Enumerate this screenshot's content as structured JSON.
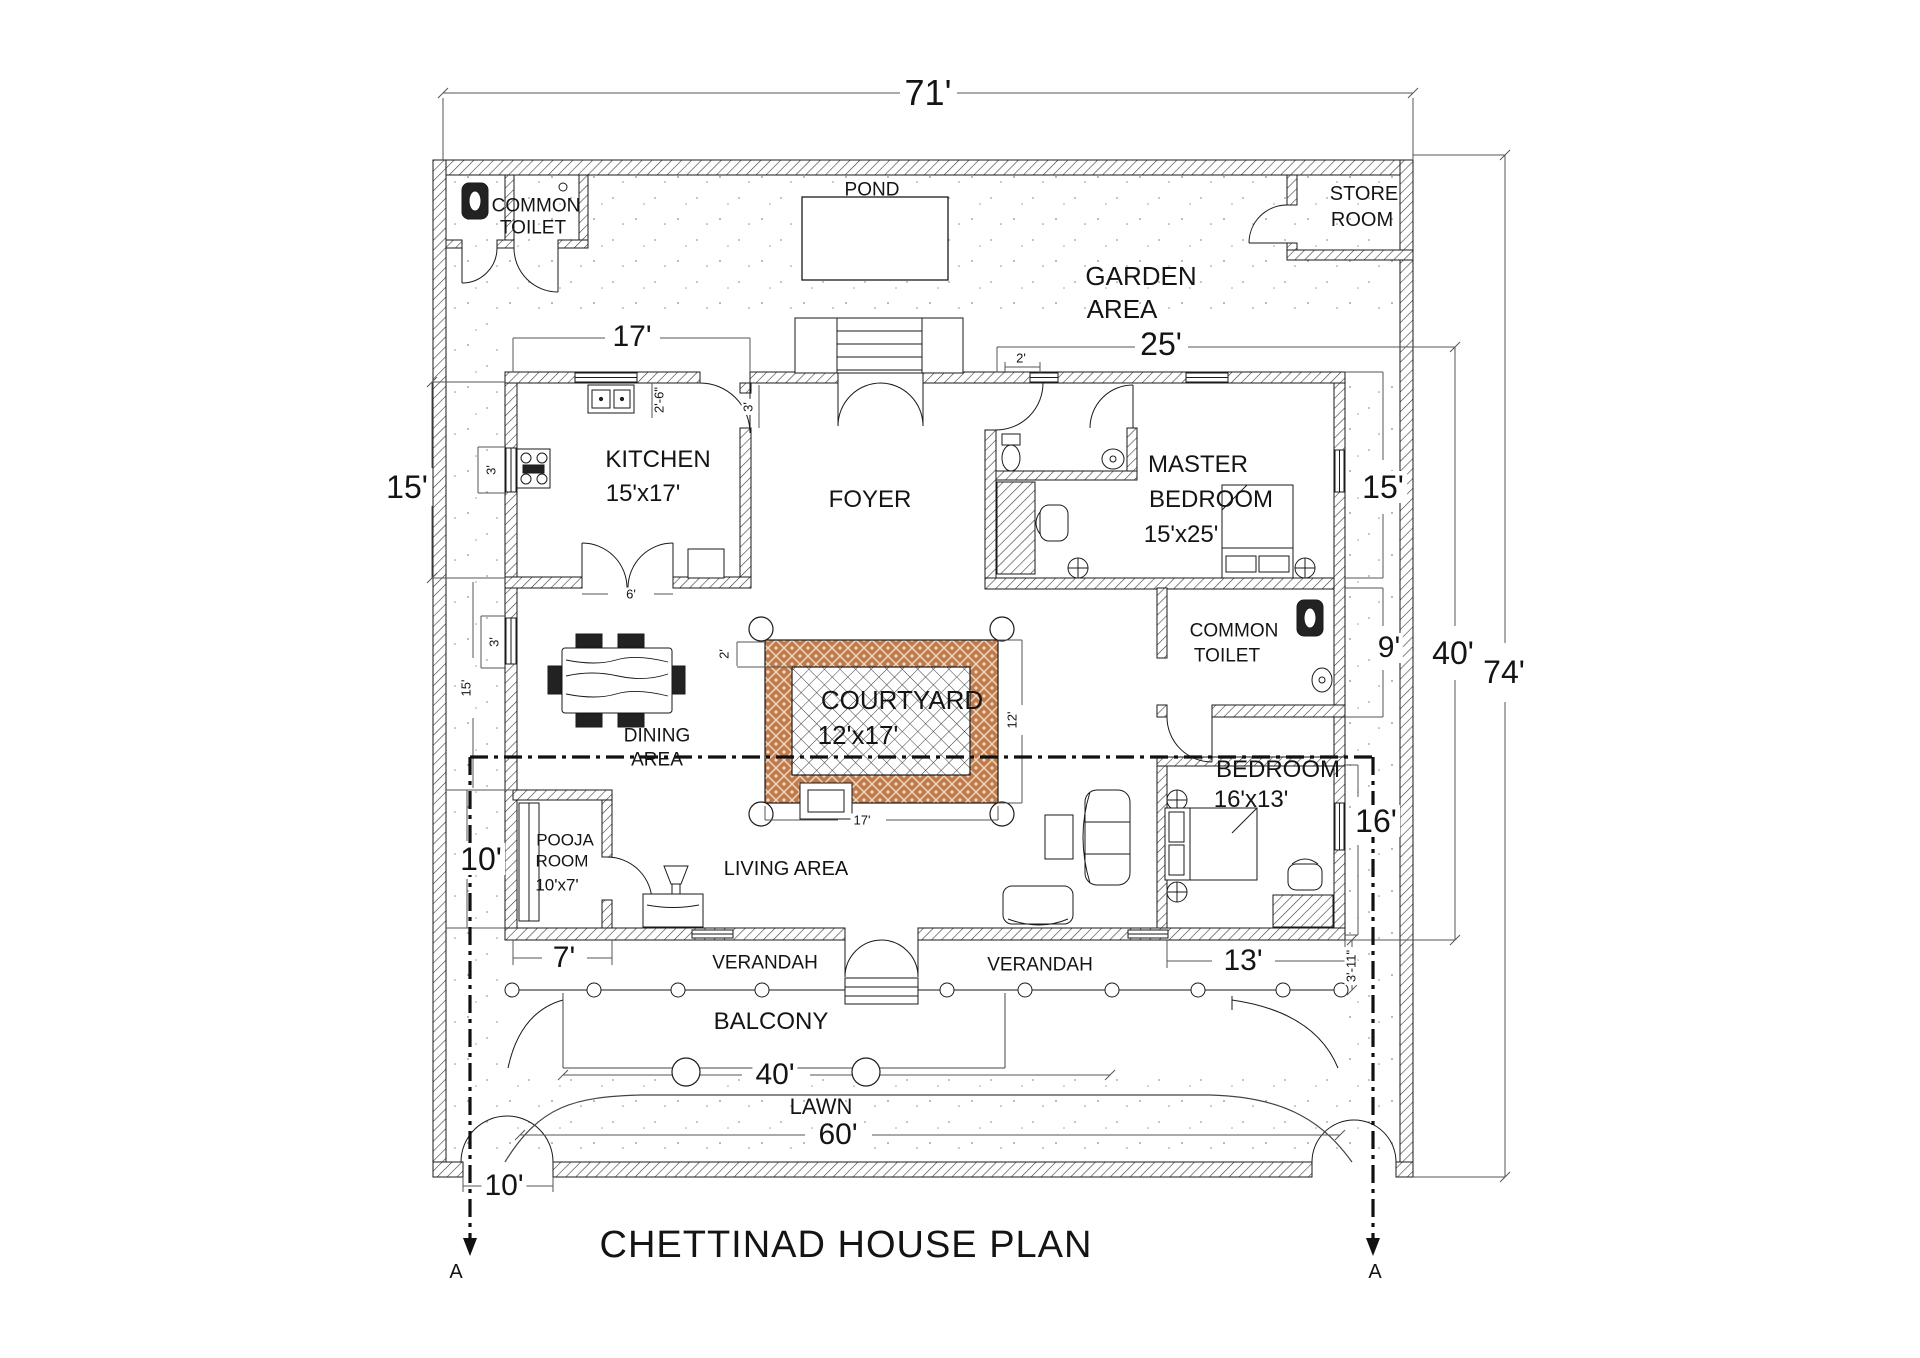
{
  "title": "CHETTINAD HOUSE PLAN",
  "rooms": {
    "common_toilet_top": {
      "l1": "COMMON",
      "l2": "TOILET"
    },
    "pond": "POND",
    "garden": {
      "l1": "GARDEN",
      "l2": "AREA"
    },
    "store_room": {
      "l1": "STORE",
      "l2": "ROOM"
    },
    "kitchen": {
      "name": "KITCHEN",
      "size": "15'x17'"
    },
    "foyer": "FOYER",
    "master_bedroom": {
      "l1": "MASTER",
      "l2": "BEDROOM",
      "size": "15'x25'"
    },
    "dining": {
      "l1": "DINING",
      "l2": "AREA"
    },
    "courtyard": {
      "name": "COURTYARD",
      "size": "12'x17'"
    },
    "common_toilet_mid": {
      "l1": "COMMON",
      "l2": "TOILET"
    },
    "bedroom": {
      "name": "BEDROOM",
      "size": "16'x13'"
    },
    "pooja": {
      "l1": "POOJA",
      "l2": "ROOM",
      "size": "10'x7'"
    },
    "living": "LIVING AREA",
    "verandah_left": "VERANDAH",
    "verandah_right": "VERANDAH",
    "balcony": "BALCONY",
    "lawn": "LAWN"
  },
  "dims": {
    "d71": "71'",
    "d74": "74'",
    "d40_right": "40'",
    "d17_top": "17'",
    "d25_top": "25'",
    "d2_window": "2'",
    "d15_left": "15'",
    "d15_right": "15'",
    "d2_6_sink": "2'-6\"",
    "d3_kitchen_door": "3'",
    "d3_stove_window": "3'",
    "d3_dining_window": "3'",
    "d15_inner": "15'",
    "d6_kitchen": "6'",
    "d2_courtyard": "2'",
    "d12_courtyard": "12'",
    "d17_courtyard": "17'",
    "d9_right": "9'",
    "d16_right": "16'",
    "d10_left": "10'",
    "d7_bottom": "7'",
    "d13_bottom": "13'",
    "d3_11": "3'-11\"",
    "d40_bottom": "40'",
    "d60_bottom": "60'",
    "d10_bottom": "10'"
  },
  "section": {
    "a_left": "A",
    "a_right": "A"
  },
  "icons": [
    "squat-toilet-icon",
    "western-toilet-icon",
    "wash-basin-icon",
    "kitchen-sink-icon",
    "stove-icon",
    "refrigerator-icon",
    "dining-table-icon",
    "double-bed-icon",
    "sofa-icon",
    "armchair-icon",
    "coffee-table-icon",
    "dresser-icon",
    "chair-icon",
    "table-lamp-icon",
    "stairs-icon",
    "column-icon",
    "pond-icon",
    "gate-icon"
  ],
  "colors": {
    "line": "#1a1a1a",
    "courtyard_border": "#c07a4b",
    "courtyard_dot": "#f0ddc6",
    "paper": "#ffffff"
  }
}
